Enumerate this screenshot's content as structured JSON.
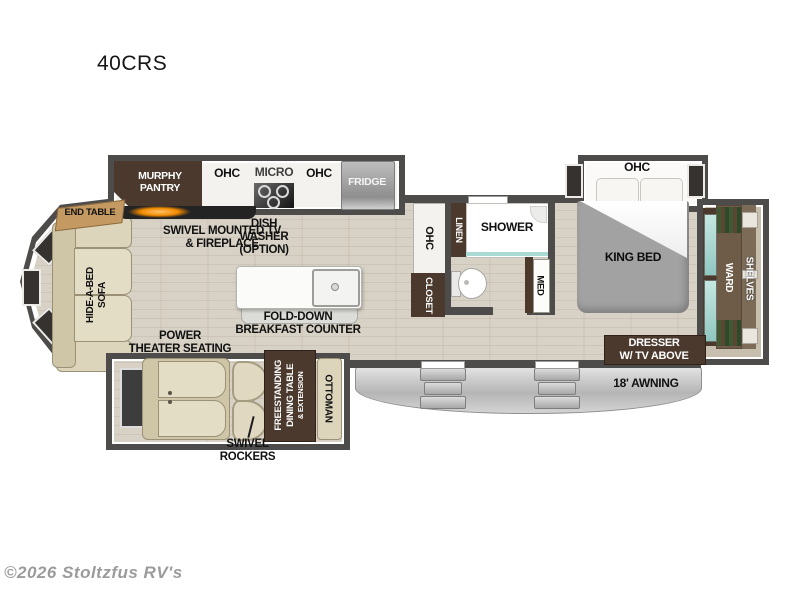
{
  "title": "40CRS",
  "watermark": "©2026 Stoltzfus RV's",
  "colors": {
    "wall": "#4e4c4a",
    "floor": "#d8d2c6",
    "brown": "#4a392c",
    "cream": "#dcd4bb",
    "cream_dark": "#cfc6a8",
    "bed_gray": "#a2a2a2",
    "teal": "#a9dad4",
    "awning": "#c9c9c9",
    "fireplace_glow": "#f08a00",
    "end_table_tan": "#c59a62"
  },
  "labels": {
    "murphy_pantry": "MURPHY\nPANTRY",
    "ohc_kitchen_left": "OHC",
    "micro": "MICRO",
    "ohc_kitchen_right": "OHC",
    "fridge": "FRIDGE",
    "end_table": "END TABLE",
    "swivel_tv": "SWIVEL MOUNTED TV\n& FIREPLACE",
    "dishwasher": "DISH\nWASHER\n(OPTION)",
    "hide_a_bed": "HIDE-A-BED\nSOFA",
    "fold_down": "FOLD-DOWN\nBREAKFAST COUNTER",
    "power_theater": "POWER\nTHEATER SEATING",
    "swivel_rockers": "SWIVEL\nROCKERS",
    "dining_table": "FREESTANDING\nDINING TABLE",
    "dining_ext": "& EXTENSION",
    "ottoman": "OTTOMAN",
    "ohc_hall": "OHC",
    "closet": "CLOSET",
    "linen": "LINEN",
    "shower": "SHOWER",
    "med": "MED",
    "ohc_bedroom": "OHC",
    "king_bed": "KING BED",
    "ward": "WARD",
    "shelves": "SHELVES",
    "dresser": "DRESSER\nW/ TV ABOVE",
    "awning": "18' AWNING"
  }
}
